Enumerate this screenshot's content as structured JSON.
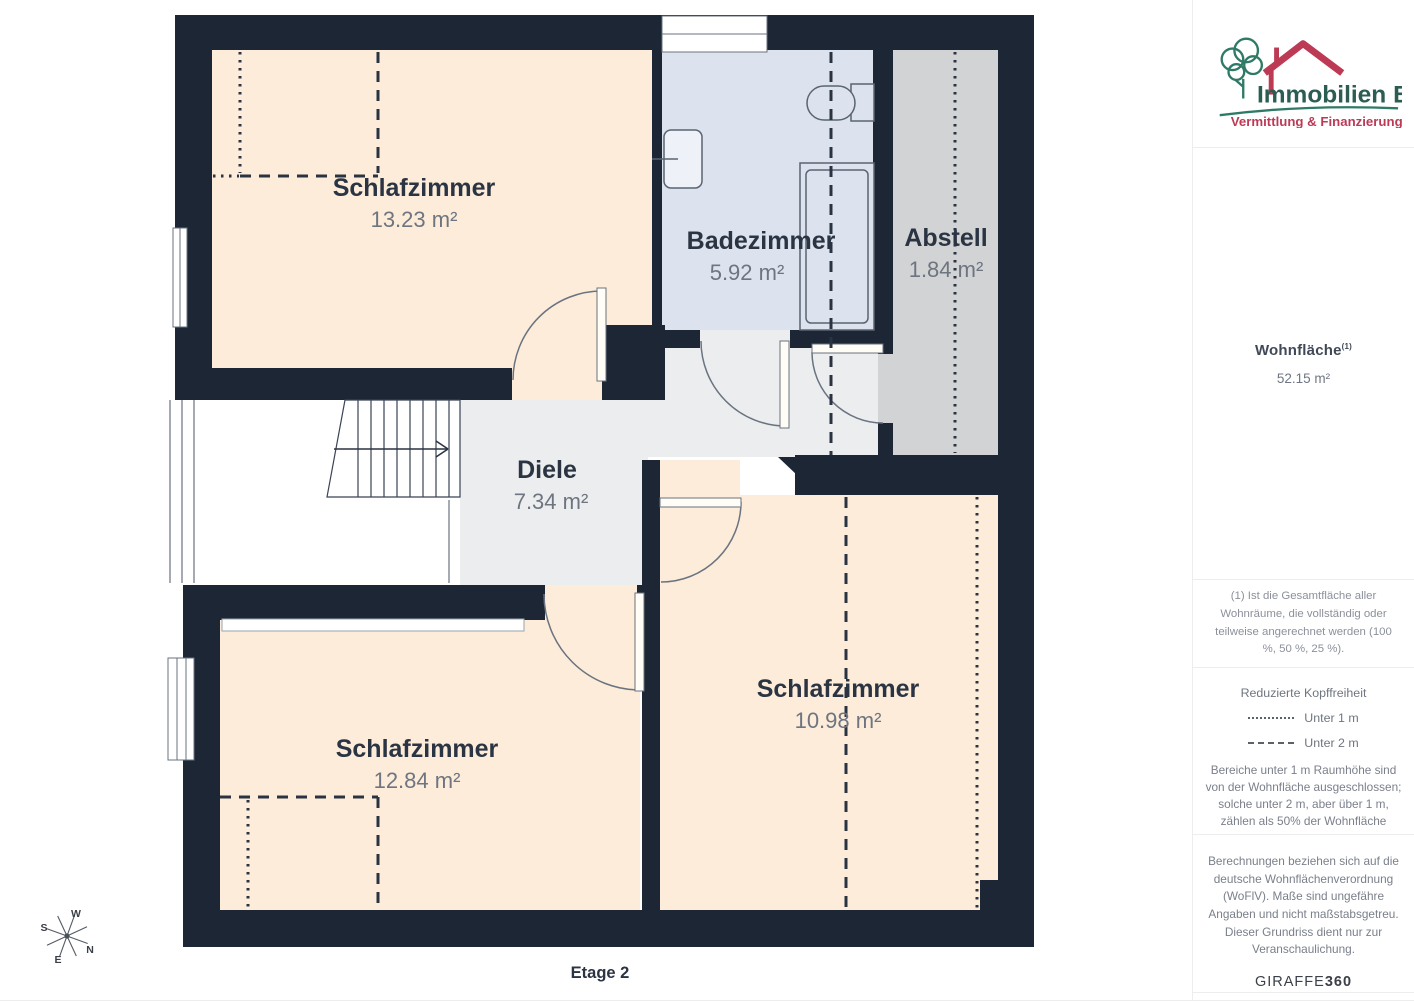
{
  "plan": {
    "floor_label": "Etage 2",
    "rooms": [
      {
        "name": "Schlafzimmer",
        "area": "13.23 m²"
      },
      {
        "name": "Badezimmer",
        "area": "5.92 m²"
      },
      {
        "name": "Abstell",
        "area": "1.84 m²"
      },
      {
        "name": "Diele",
        "area": "7.34 m²"
      },
      {
        "name": "Schlafzimmer",
        "area": "10.98 m²"
      },
      {
        "name": "Schlafzimmer",
        "area": "12.84 m²"
      }
    ],
    "compass": {
      "n": "N",
      "s": "S",
      "e": "E",
      "w": "W"
    },
    "colors": {
      "wall": "#1c2634",
      "bedroom_fill": "#fcecd9",
      "bathroom_fill": "#dde3ee",
      "storage_fill": "#d2d3d4",
      "hallway_fill": "#ecedee"
    }
  },
  "sidebar": {
    "logo": {
      "title": "Immobilien Bart",
      "subtitle": "Vermittlung & Finanzierung",
      "green": "#2f7a66",
      "red": "#bd3a55"
    },
    "living_area": {
      "label": "Wohnfläche",
      "footnote_marker": "(1)",
      "value": "52.15 m²"
    },
    "footnote": "(1) Ist die Gesamtfläche aller Wohnräume, die vollständig oder teilweise angerechnet werden (100 %, 50 %, 25 %).",
    "headroom": {
      "title": "Reduzierte Kopffreiheit",
      "legend": [
        {
          "style": "dotted",
          "label": "Unter 1 m"
        },
        {
          "style": "dashed",
          "label": "Unter 2 m"
        }
      ],
      "description": "Bereiche unter 1 m Raumhöhe sind von der Wohnfläche ausgeschlossen; solche unter 2 m, aber über 1 m, zählen als 50% der Wohnfläche"
    },
    "disclaimer": "Berechnungen beziehen sich auf die deutsche Wohnflächenverordnung (WoFlV). Maße sind ungefähre Angaben und nicht maßstabsgetreu. Dieser Grundriss dient nur zur Veranschaulichung.",
    "brand": {
      "name": "GIRAFFE",
      "suffix": "360"
    }
  }
}
